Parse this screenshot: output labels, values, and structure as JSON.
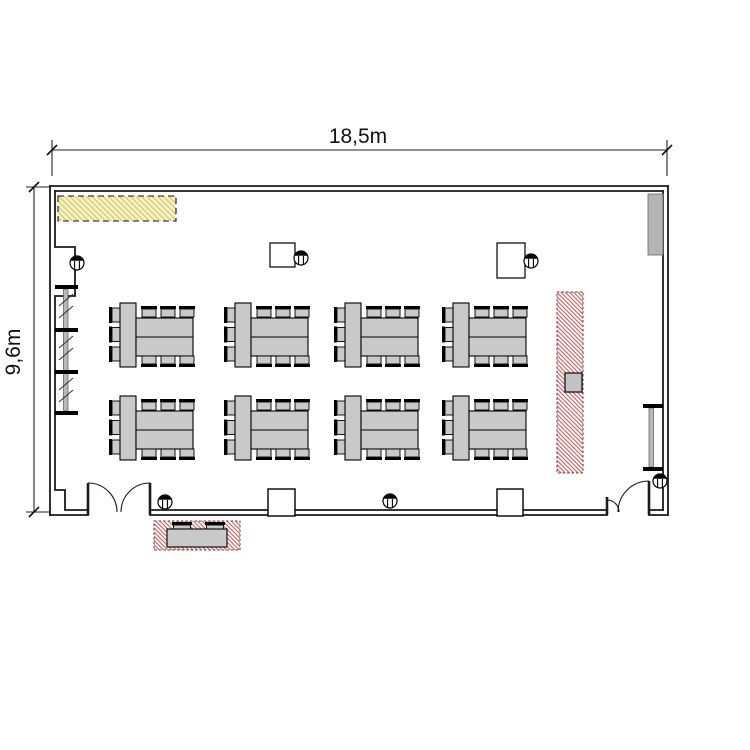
{
  "page": {
    "background": "#ffffff"
  },
  "dimension_labels": {
    "width": "18,5m",
    "height": "9,6m"
  },
  "room": {
    "width_meters": "18.5",
    "height_meters": "9.6"
  },
  "colors": {
    "wall": "#1a1a1a",
    "furniture": "#c9c9c9",
    "yellow_fill": "#faf3c2",
    "yellow_hatch": "#d8ca83",
    "red_hatch": "#c96060",
    "red_border": "#7a3a3a",
    "radiator": "#b9b9b9",
    "cabinet": "#b4b4b4"
  },
  "furniture": {
    "table_group_rows_y": [
      303,
      396
    ],
    "table_group_cols_x": [
      120,
      235,
      345,
      453
    ],
    "table_group_count": 8,
    "chairs_per_group": 9,
    "stools": [
      [
        77,
        263
      ],
      [
        301,
        258
      ],
      [
        531,
        261
      ],
      [
        165,
        502
      ],
      [
        390,
        501
      ],
      [
        660,
        481
      ]
    ],
    "square_tables": [
      [
        270,
        243,
        25,
        24
      ],
      [
        497,
        243,
        28,
        35
      ]
    ],
    "outdoor_chairs_x": [
      172,
      205
    ],
    "outdoor_table": [
      167,
      529,
      60,
      18
    ],
    "outdoor_zone": [
      154,
      521,
      86,
      29
    ],
    "red_zone_rect": [
      557,
      292,
      26,
      181
    ],
    "red_zone_equipment": [
      565,
      373,
      17,
      19
    ],
    "yellow_zone_rect": [
      58,
      196,
      118,
      25
    ]
  }
}
